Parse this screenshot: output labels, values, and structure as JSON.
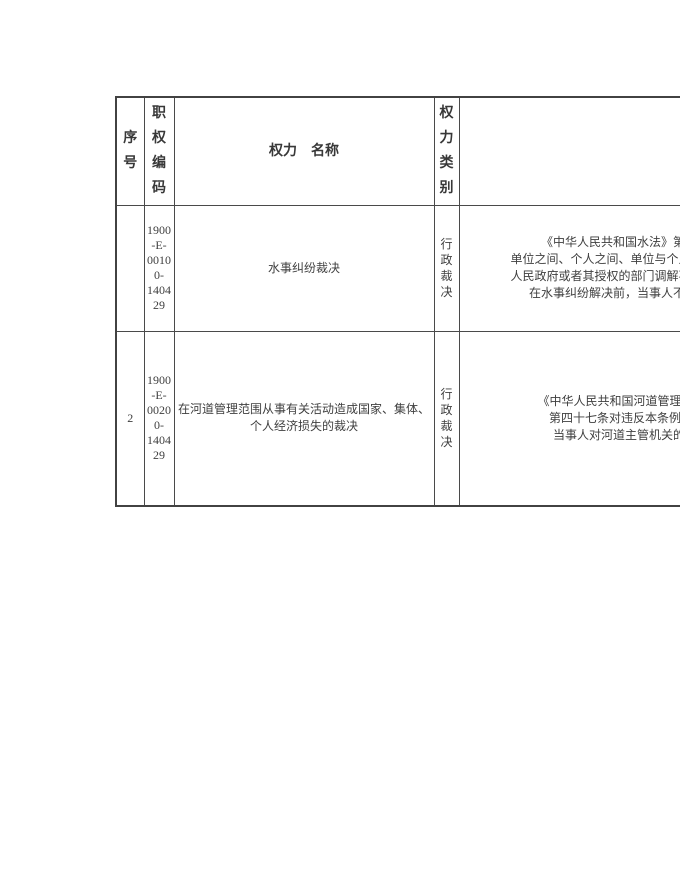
{
  "colors": {
    "background": "#ffffff",
    "border": "#4a4a4a",
    "text": "#3f3f3f"
  },
  "table": {
    "headers": {
      "index": "序号",
      "code": "职权编码",
      "name": "权力　名称",
      "category": "权力类别",
      "legal": ""
    },
    "rows": [
      {
        "index": "",
        "code": "1900\n-E-\n0010\n0-\n1404\n29",
        "name": "水事纠纷裁决",
        "category": "行政裁决",
        "legal_lines": [
          "《中华人民共和国水法》第五十七条",
          "单位之间、个人之间、单位与个人之间发生",
          "人民政府或者其授权的部门调解不成的，当",
          "在水事纠纷解决前，当事人不得单方面"
        ]
      },
      {
        "index": "2",
        "code": "1900\n-E-\n0020\n0-\n1404\n29",
        "name": "在河道管理范围从事有关活动造成国家、集体、\n个人经济损失的裁决",
        "category": "行政裁决",
        "legal_lines": [
          "《中华人民共和国河道管理条例》（国",
          "第四十七条对违反本条例规定，造",
          "当事人对河道主管机关的处理决定"
        ]
      }
    ]
  }
}
